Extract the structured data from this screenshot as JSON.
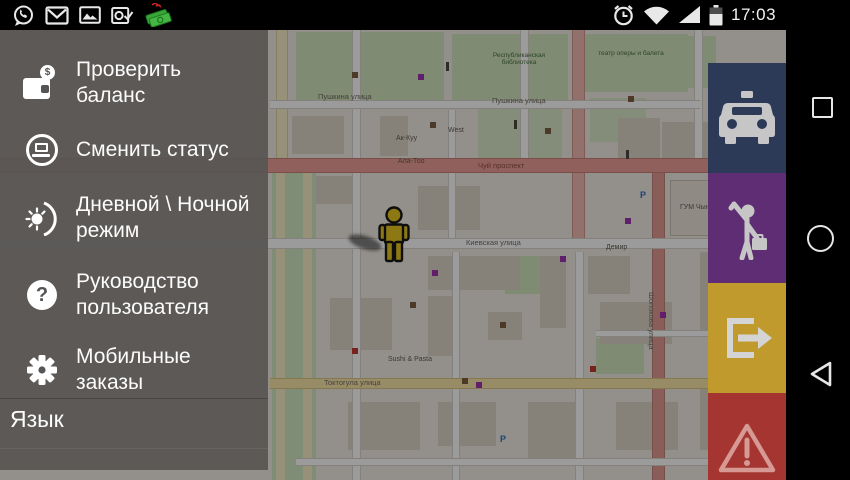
{
  "status_bar": {
    "time": "17:03",
    "left_icons": [
      "whatsapp-icon",
      "gmail-icon",
      "gallery-icon",
      "outlook-icon",
      "money-transfer-icon"
    ],
    "right_icons": [
      "alarm-icon",
      "wifi-icon",
      "signal-icon",
      "battery-icon"
    ]
  },
  "drawer": {
    "items": [
      {
        "label": "Проверить баланс",
        "icon": "wallet-icon"
      },
      {
        "label": "Сменить статус",
        "icon": "status-icon"
      },
      {
        "label": "Дневной \\ Ночной режим",
        "icon": "day-night-icon"
      },
      {
        "label": "Руководство пользователя",
        "icon": "help-icon"
      },
      {
        "label": "Мобильные заказы",
        "icon": "gear-icon"
      }
    ],
    "language_label": "Язык"
  },
  "action_buttons": [
    {
      "name": "taxi",
      "color": "#2c3a58"
    },
    {
      "name": "hail-passenger",
      "color": "#5f2d73"
    },
    {
      "name": "exit",
      "color": "#c19a2e"
    },
    {
      "name": "warning",
      "color": "#a43530"
    }
  ],
  "navbar": {
    "buttons": [
      "recents",
      "home",
      "back"
    ]
  },
  "map": {
    "labels": [
      {
        "text": "Пушкина улица",
        "x": 318,
        "y": 62,
        "cls": ""
      },
      {
        "text": "Пушкина улица",
        "x": 492,
        "y": 66,
        "cls": ""
      },
      {
        "text": "Чуй проспект",
        "x": 478,
        "y": 131,
        "cls": "road"
      },
      {
        "text": "Киевская улица",
        "x": 466,
        "y": 208,
        "cls": ""
      },
      {
        "text": "Токтогула улица",
        "x": 324,
        "y": 348,
        "cls": ""
      },
      {
        "text": "ГУМ Чынар",
        "x": 680,
        "y": 174,
        "cls": "poi"
      },
      {
        "text": "West",
        "x": 448,
        "y": 97,
        "cls": "poi"
      },
      {
        "text": "Ак-Куу",
        "x": 396,
        "y": 105,
        "cls": "poi"
      },
      {
        "text": "Ала-Тоо",
        "x": 398,
        "y": 128,
        "cls": "poi"
      },
      {
        "text": "Демир",
        "x": 606,
        "y": 214,
        "cls": "poi"
      },
      {
        "text": "Sushi & Pasta",
        "x": 388,
        "y": 326,
        "cls": "poi"
      },
      {
        "text": "Республиканская библиотека",
        "x": 480,
        "y": 22,
        "cls": "poi-green"
      },
      {
        "text": "театр оперы и балета",
        "x": 592,
        "y": 20,
        "cls": "poi-green"
      },
      {
        "text": "Шопокова улица",
        "x": 656,
        "y": 262,
        "cls": "vert"
      },
      {
        "text": "P",
        "x": 640,
        "y": 160,
        "cls": "parking"
      },
      {
        "text": "P",
        "x": 500,
        "y": 404,
        "cls": "parking"
      }
    ]
  }
}
